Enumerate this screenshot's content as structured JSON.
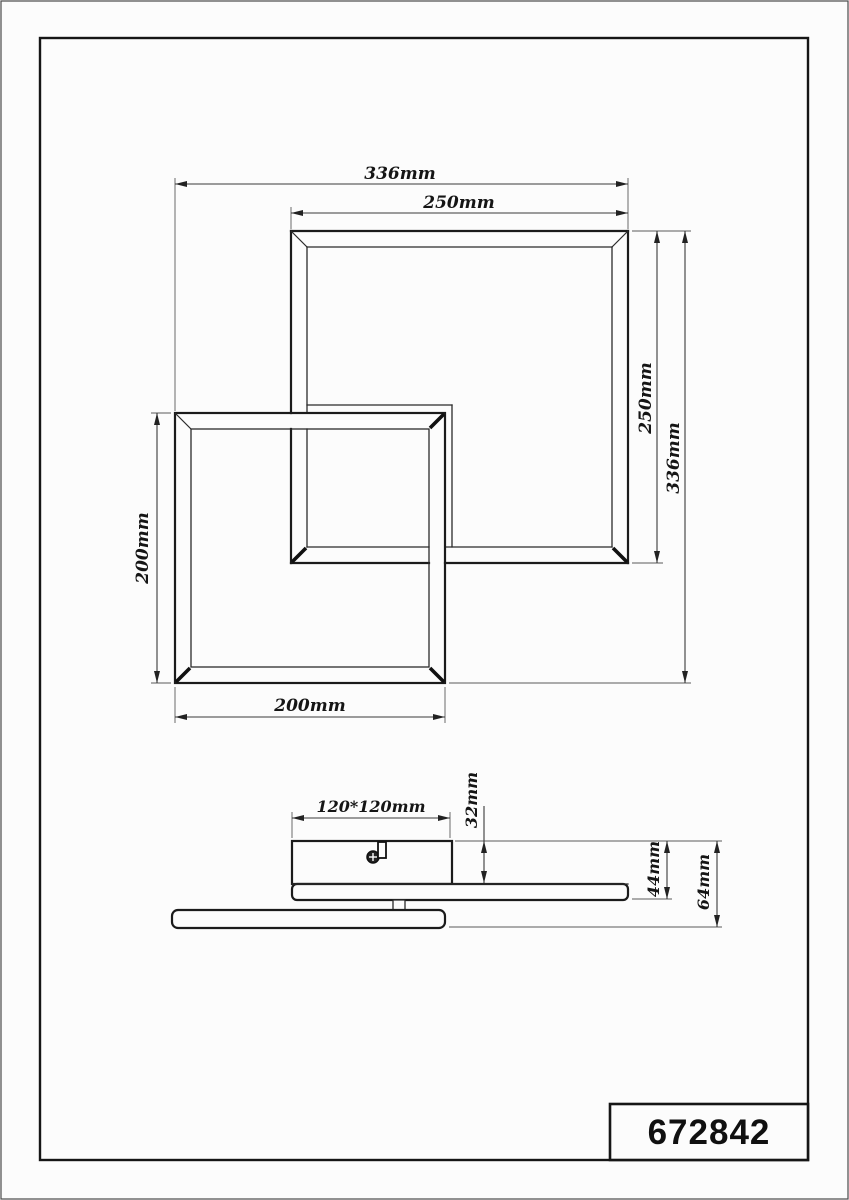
{
  "colors": {
    "background": "#fcfcfc",
    "object_line": "#1b1b1b",
    "dimension_line": "#3a3a3a",
    "text": "#151515"
  },
  "top_view": {
    "dim_total_width": "336mm",
    "dim_large_square_width": "250mm",
    "dim_large_square_height": "250mm",
    "dim_total_height": "336mm",
    "dim_small_square_height": "200mm",
    "dim_small_square_width": "200mm"
  },
  "side_view": {
    "dim_canopy": "120*120mm",
    "dim_canopy_height": "32mm",
    "dim_upper_frame_depth": "44mm",
    "dim_total_depth": "64mm"
  },
  "title_block": {
    "part_number": "672842"
  }
}
